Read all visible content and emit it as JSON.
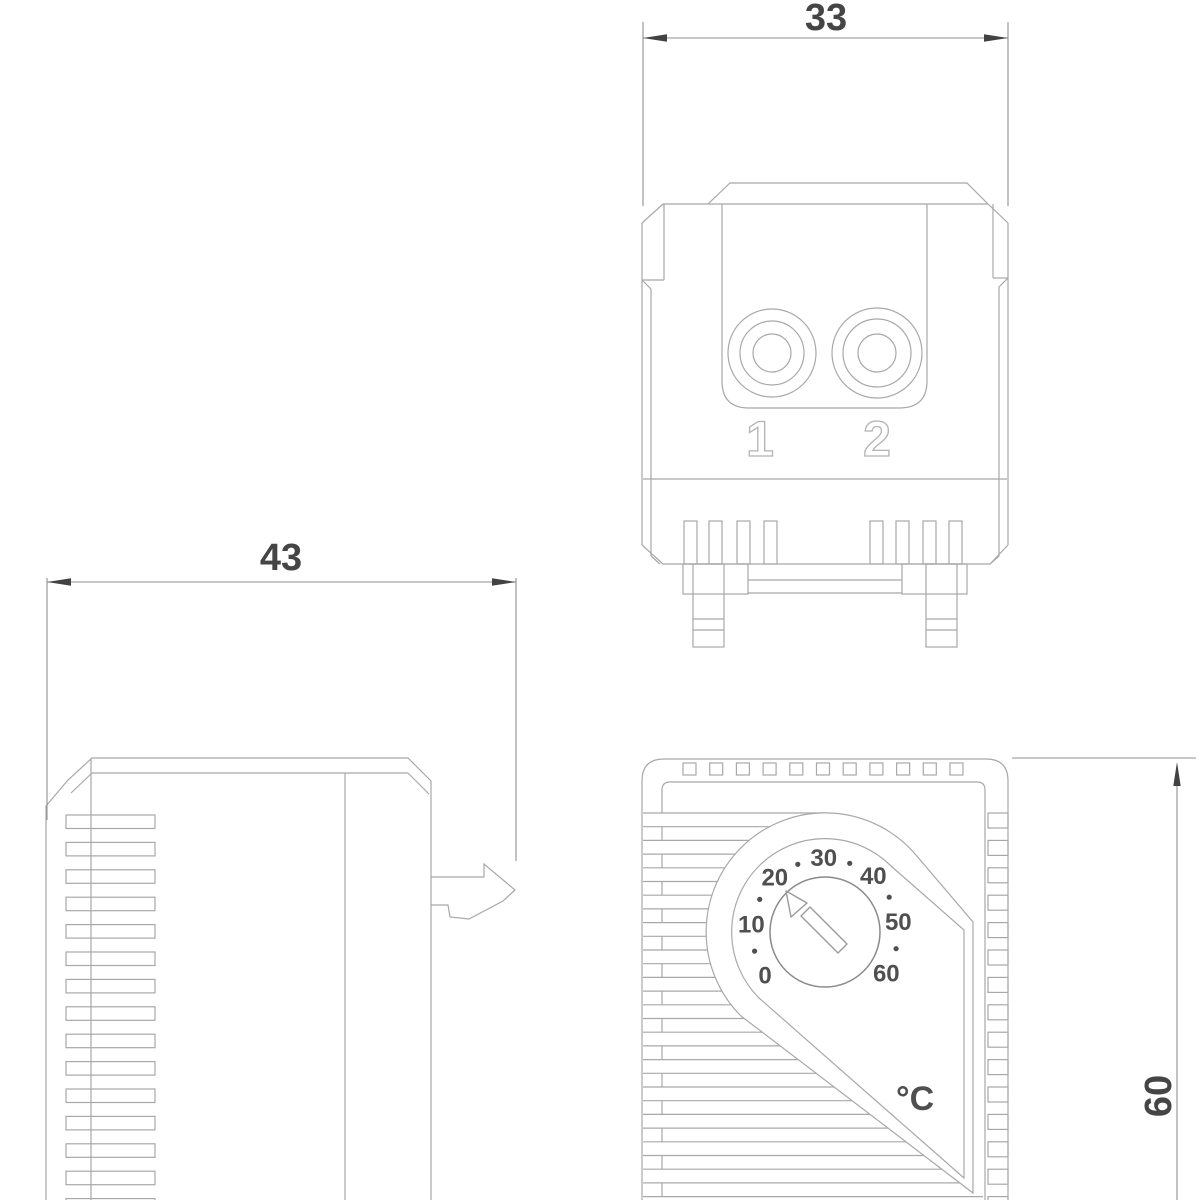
{
  "colors": {
    "background": "#ffffff",
    "outline": "#a8a8a8",
    "dimension_line": "#8f8f8f",
    "dimension_text": "#454545",
    "dial_text": "#4f4f4f",
    "engraved_label": "#b3b3b3"
  },
  "dimensions": {
    "top_width": "33",
    "side_width": "43",
    "front_height": "60"
  },
  "top_view": {
    "terminals": [
      {
        "label": "1"
      },
      {
        "label": "2"
      }
    ]
  },
  "front_view": {
    "dial": {
      "tick_labels": [
        "0",
        "10",
        "20",
        "30",
        "40",
        "50",
        "60"
      ],
      "unit": "°C"
    }
  }
}
